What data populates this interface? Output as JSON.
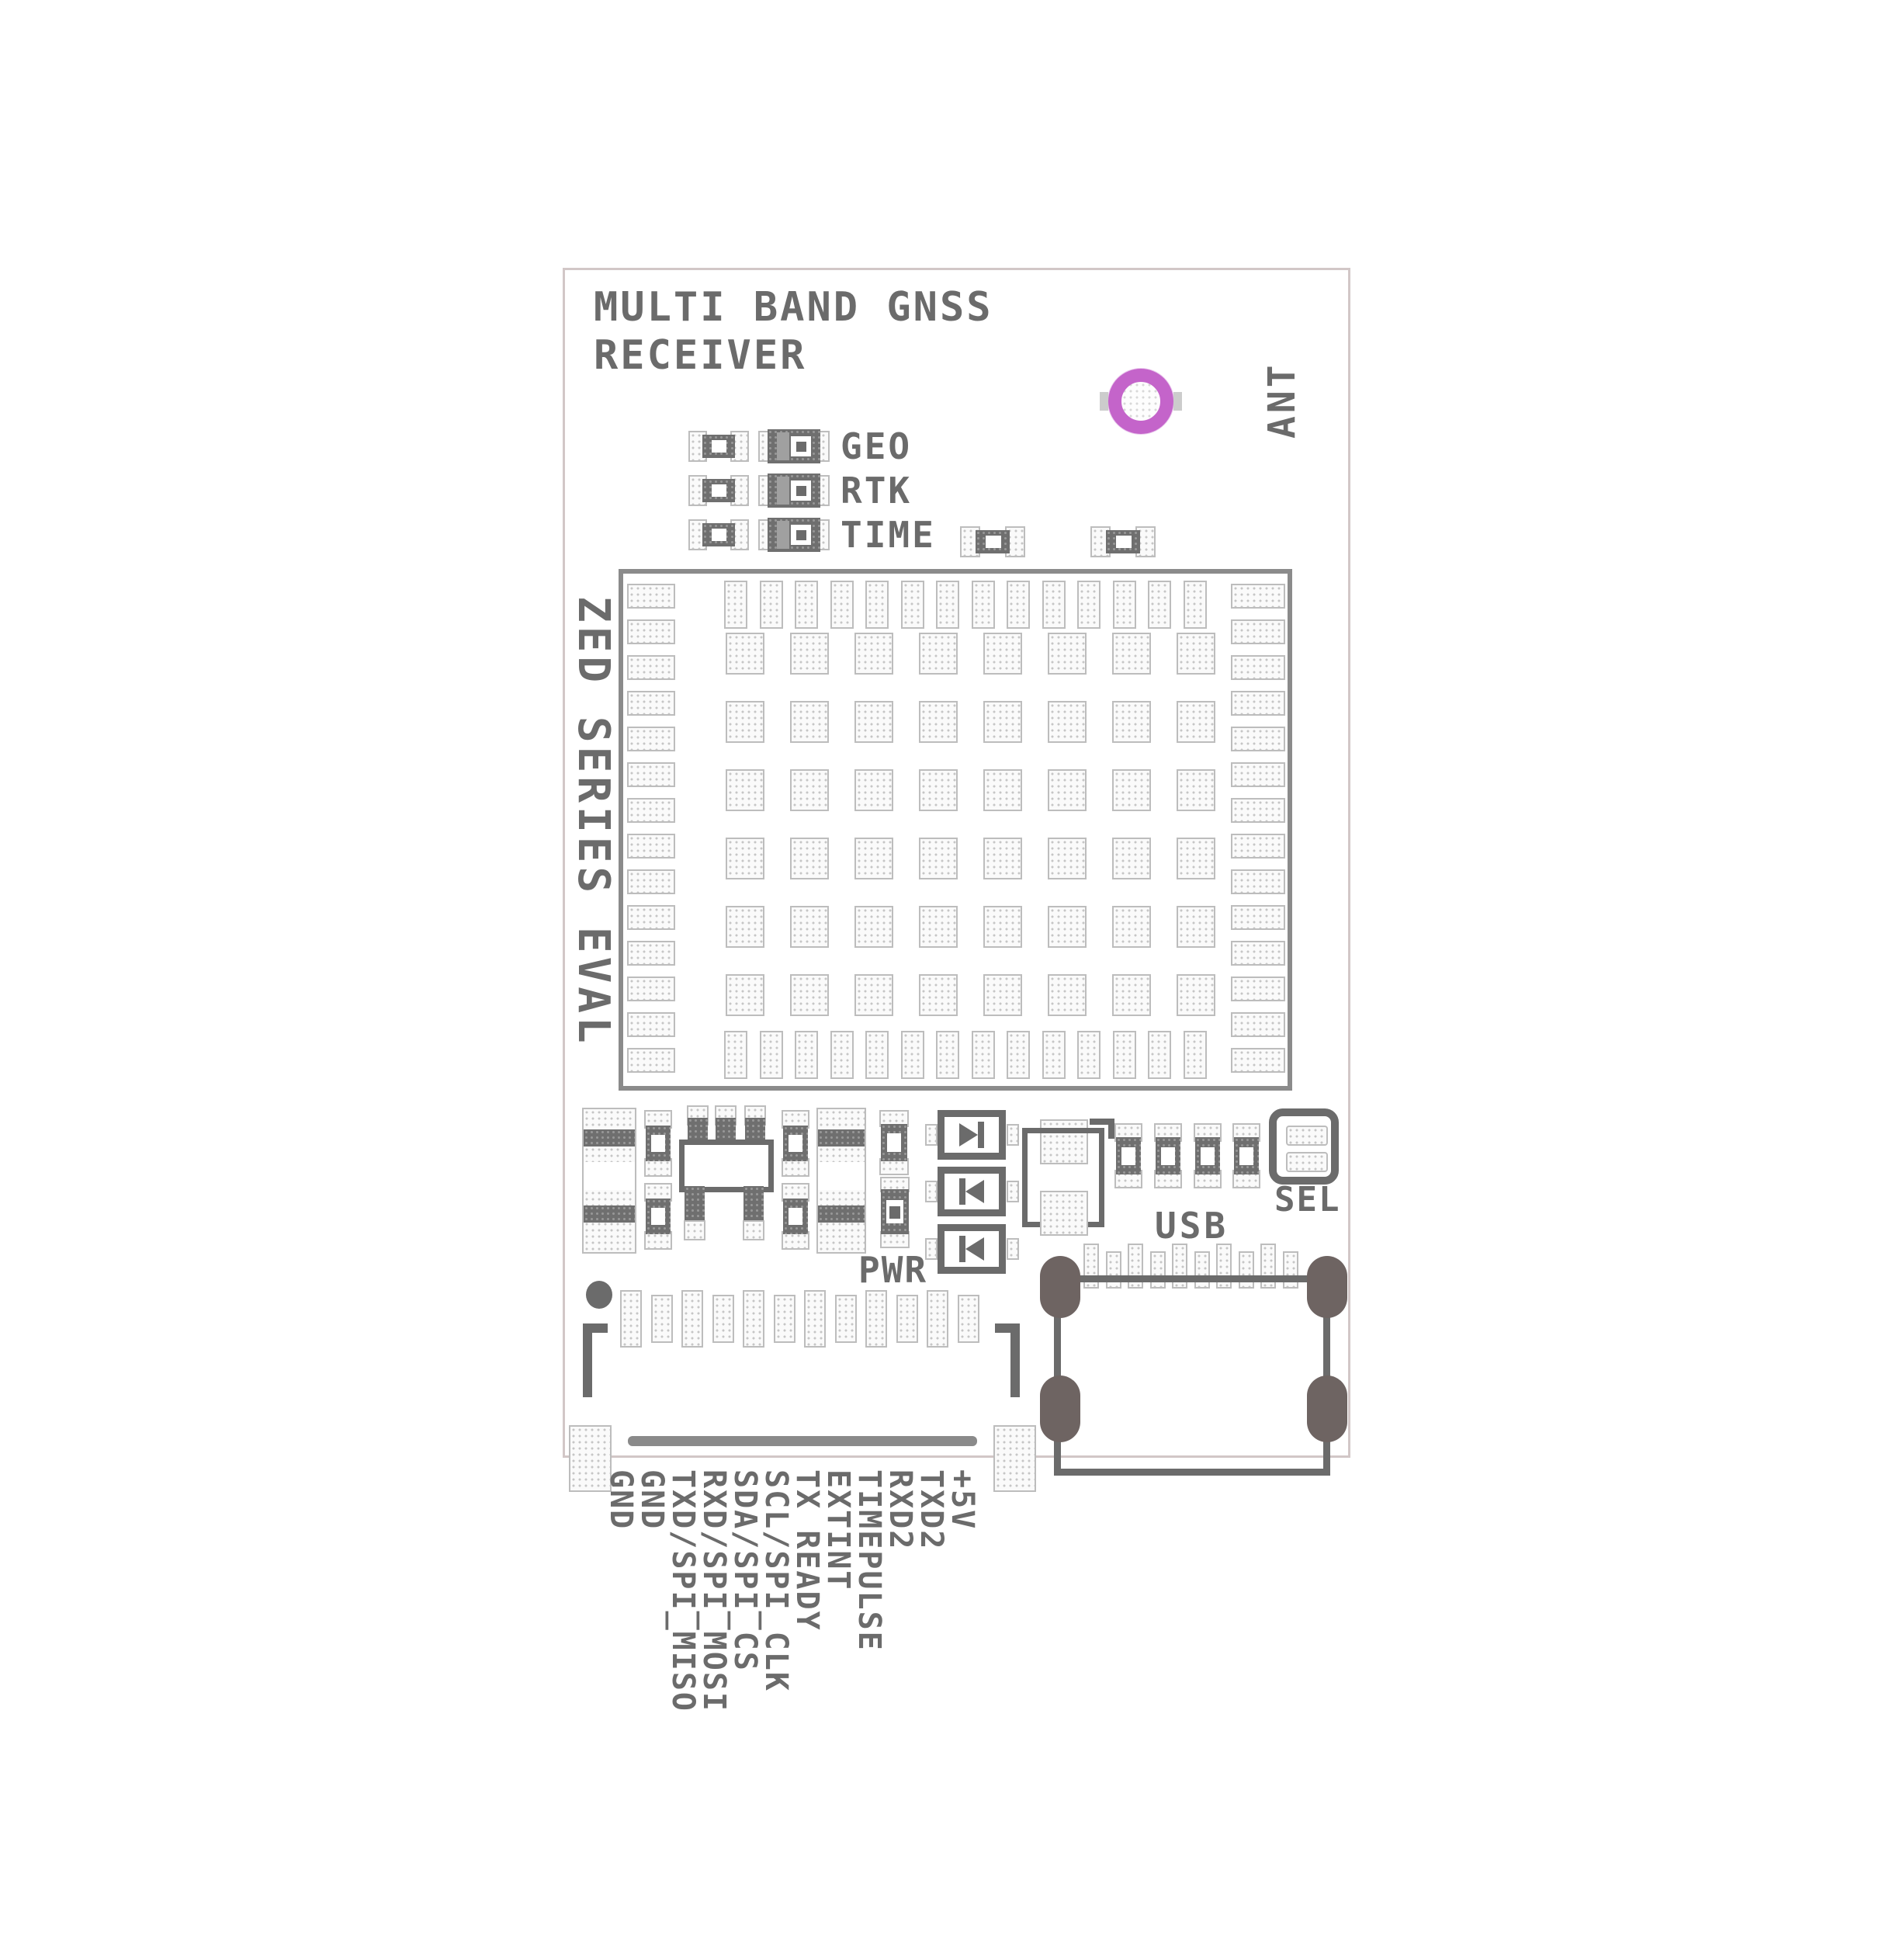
{
  "title": {
    "line1": "MULTI BAND GNSS",
    "line2": "RECEIVER"
  },
  "side_text": "ZED SERIES EVAL",
  "ant_label": "ANT",
  "led_labels": [
    "GEO",
    "RTK",
    "TIME"
  ],
  "pwr_label": "PWR",
  "usb_label": "USB",
  "sel_label": "SEL",
  "pin_labels": [
    "GND",
    "GND",
    "TXD/SPI_MISO",
    "RXD/SPI_MOSI",
    "SDA/SPI_CS",
    "SCL/SPI_CLK",
    "TX READY",
    "EXTINT",
    "TIMEPULSE",
    "RXD2",
    "TXD2",
    "+5V"
  ],
  "colors": {
    "silkscreen": "#6b6b6b",
    "module_border": "#8b8b8b",
    "board_border": "#d2c7c7",
    "ant_ring": "#c464ca",
    "usb_oval_pad": "#6e6462",
    "pad_dot": "#c6c6c6"
  },
  "layout_counts": {
    "module_top_pads": 14,
    "module_bottom_pads": 14,
    "module_left_pads": 14,
    "module_right_pads": 14,
    "module_grid_cols": 8,
    "module_grid_rows": 6,
    "header_pins": 12,
    "usb_pins": 10
  }
}
